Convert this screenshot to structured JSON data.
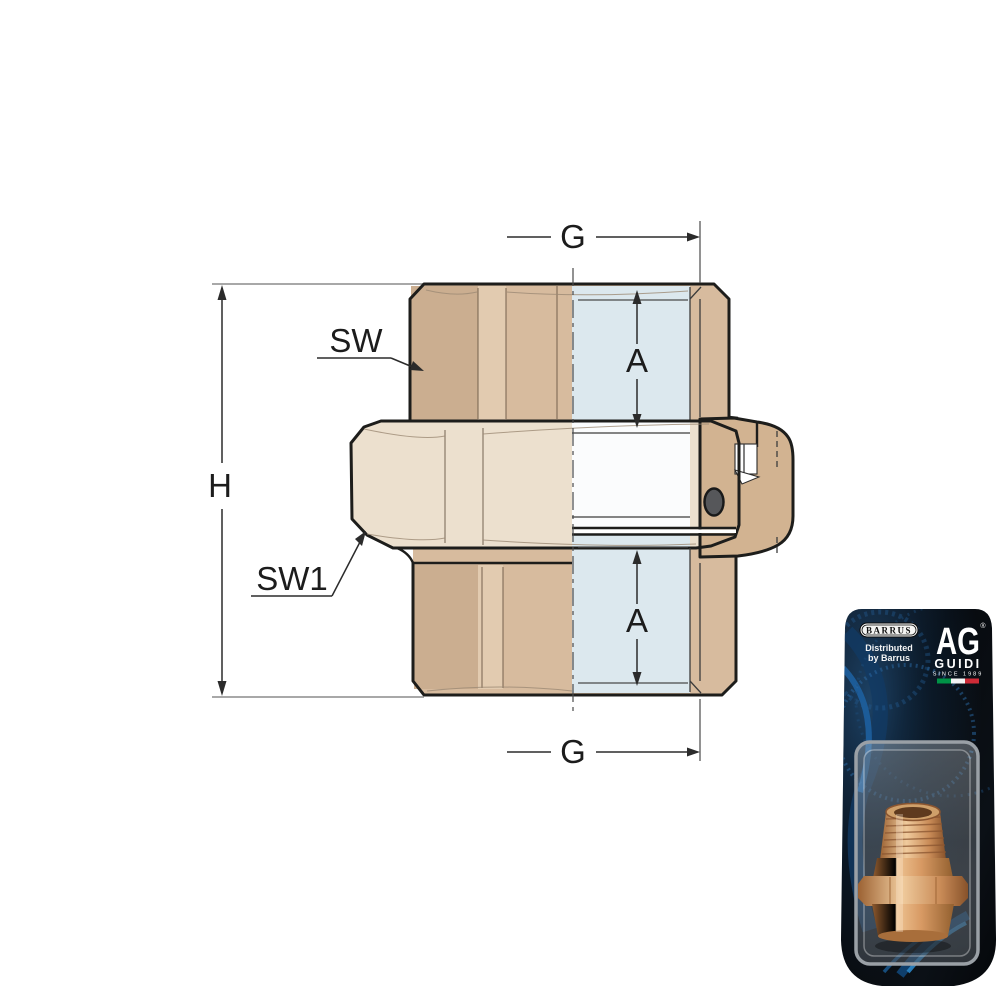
{
  "diagram": {
    "dimension_labels": {
      "g_top": "G",
      "a_top": "A",
      "h": "H",
      "sw": "SW",
      "sw1": "SW1",
      "a_bottom": "A",
      "g_bottom": "G"
    },
    "colors": {
      "body_tan": "#d7bb9e",
      "body_tan_dark": "#cbae90",
      "body_tan_light": "#e2cbb0",
      "nut_cream": "#ece0ce",
      "section_blue": "#dce8ee",
      "section_white": "#fbfcfd",
      "tail_tan": "#d2b391",
      "outline": "#1d1d1b",
      "oring_gray": "#56575a"
    }
  },
  "packaging": {
    "barrus_logo_text": "BARRUS",
    "distributed_line1": "Distributed",
    "distributed_line2": "by Barrus",
    "guidi_monogram": "AG",
    "registered_mark": "®",
    "guidi_name": "GUIDI",
    "guidi_tagline": "SINCE 1989",
    "flag_colors": {
      "green": "#009246",
      "white": "#f4f4f4",
      "red": "#ce2b37"
    },
    "card_color": "#0a0d12",
    "accent_blue": "#1f6fbf"
  }
}
